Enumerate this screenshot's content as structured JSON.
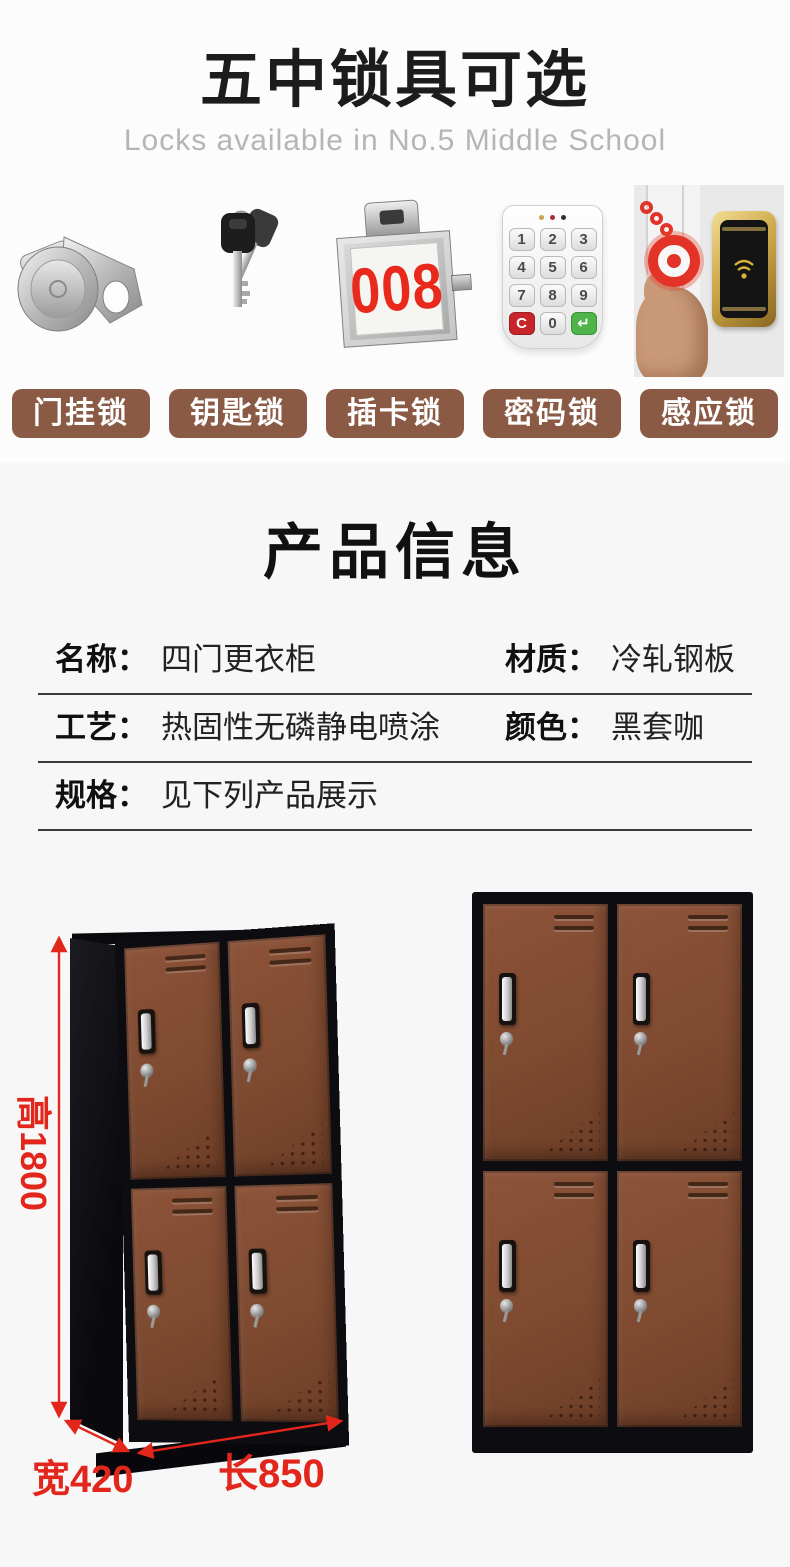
{
  "header": {
    "title": "五中锁具可选",
    "subtitle": "Locks available in No.5 Middle School"
  },
  "locks": {
    "items": [
      {
        "label": "门挂锁",
        "photo": "cam-lock"
      },
      {
        "label": "钥匙锁",
        "photo": "keys"
      },
      {
        "label": "插卡锁",
        "photo": "number-plate-lock"
      },
      {
        "label": "密码锁",
        "photo": "password-keypad"
      },
      {
        "label": "感应锁",
        "photo": "rfid-induction-lock"
      }
    ],
    "number_plate": "008",
    "keypad_keys": [
      "1",
      "2",
      "3",
      "4",
      "5",
      "6",
      "7",
      "8",
      "9",
      "C",
      "0",
      "↵"
    ]
  },
  "product_info": {
    "title": "产品信息",
    "rows": [
      {
        "cells": [
          {
            "label": "名称：",
            "value": "四门更衣柜"
          },
          {
            "label": "材质：",
            "value": "冷轧钢板"
          }
        ]
      },
      {
        "cells": [
          {
            "label": "工艺：",
            "value": "热固性无磷静电喷涂"
          },
          {
            "label": "颜色：",
            "value": "黑套咖"
          }
        ]
      },
      {
        "cells": [
          {
            "label": "规格：",
            "value": "见下列产品展示"
          }
        ]
      }
    ]
  },
  "dimensions": {
    "height": "高1800",
    "width": "宽420",
    "length": "长850"
  },
  "colors": {
    "accent_red": "#e2261b",
    "badge_brown": "#8a5a45",
    "door_brown": "#7d4a31",
    "frame_black": "#0d0d11",
    "gold": "#cda84a"
  }
}
